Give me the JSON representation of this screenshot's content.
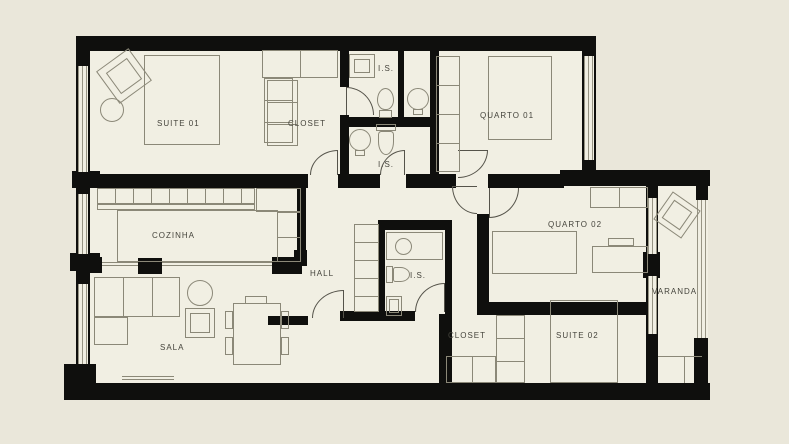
{
  "plan": {
    "type": "apartment-floor-plan",
    "language": "pt-BR"
  },
  "rooms": {
    "suite01": "SUITE 01",
    "closetTop": "CLOSET",
    "isTop": "I.S.",
    "isUpper2": "I.S.",
    "quarto01": "QUARTO 01",
    "cozinha": "COZINHA",
    "hall": "HALL",
    "isHall": "I.S.",
    "quarto02": "QUARTO 02",
    "varanda": "VARANDA",
    "sala": "SALA",
    "closetBottom": "CLOSET",
    "suite02": "SUITE 02"
  },
  "colors": {
    "background": "#eae7da",
    "floor": "#f1efe3",
    "wall": "#0f0f0d",
    "furniture_line": "#8b8878",
    "window_line": "#979484",
    "label_text": "#45443c"
  }
}
